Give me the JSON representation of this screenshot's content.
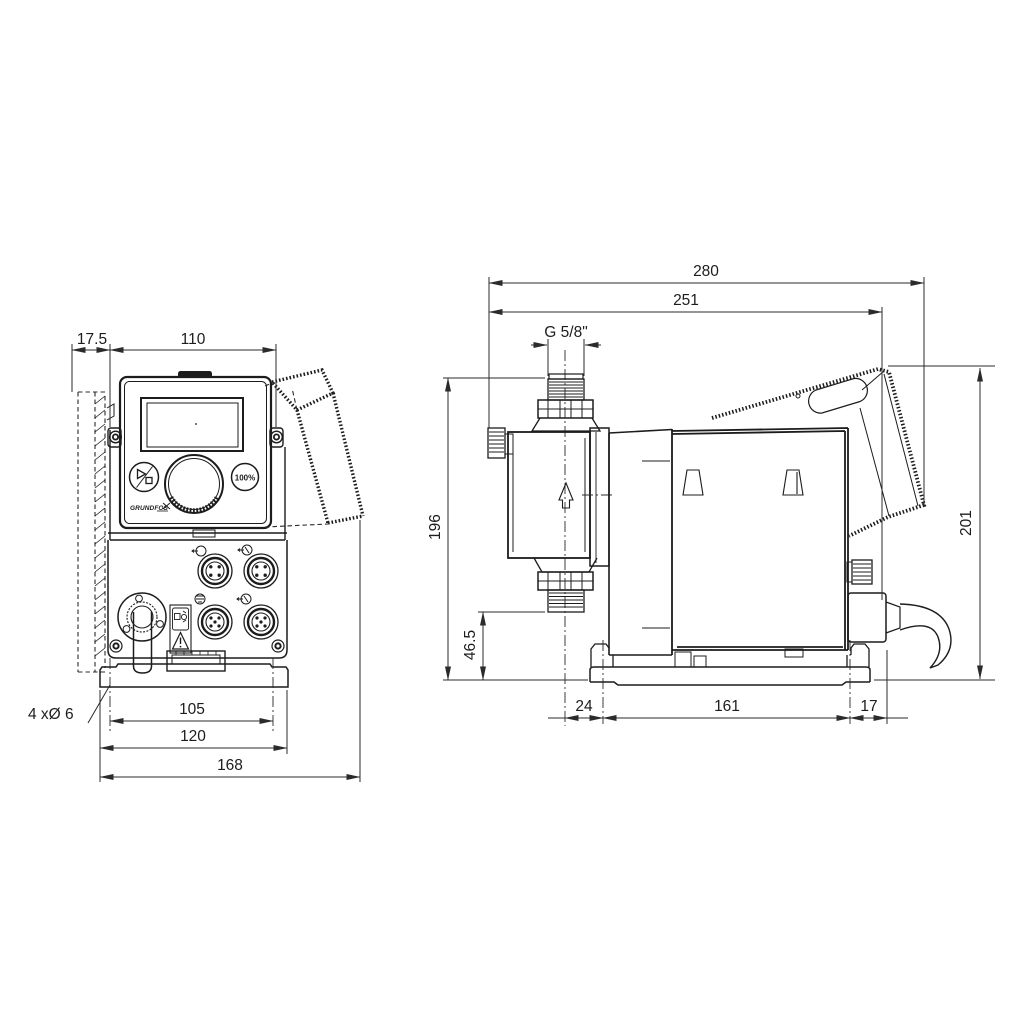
{
  "drawing_type": "dimensional technical drawing, dosing pump, front and side views",
  "front_view": {
    "dim_wall_offset": "17.5",
    "dim_panel_width": "110",
    "dim_hole_spacing": "105",
    "dim_plate_width": "120",
    "dim_overall_width": "168",
    "holes_label": "4 xØ 6",
    "panel": {
      "boost_button_label": "100%",
      "brand": "GRUNDFOS"
    }
  },
  "side_view": {
    "dim_overall_depth": "280",
    "dim_depth_to_rear": "251",
    "thread_label": "G 5/8\"",
    "dim_height_to_top_valve": "196",
    "dim_base_to_bottom_valve": "46.5",
    "dim_front_to_hole": "24",
    "dim_hole_spacing": "161",
    "dim_hole_to_rear": "17",
    "dim_overall_height": "201"
  },
  "colors": {
    "line": "#1c1c1c",
    "dimension": "#2b2b2b",
    "background": "#ffffff"
  }
}
